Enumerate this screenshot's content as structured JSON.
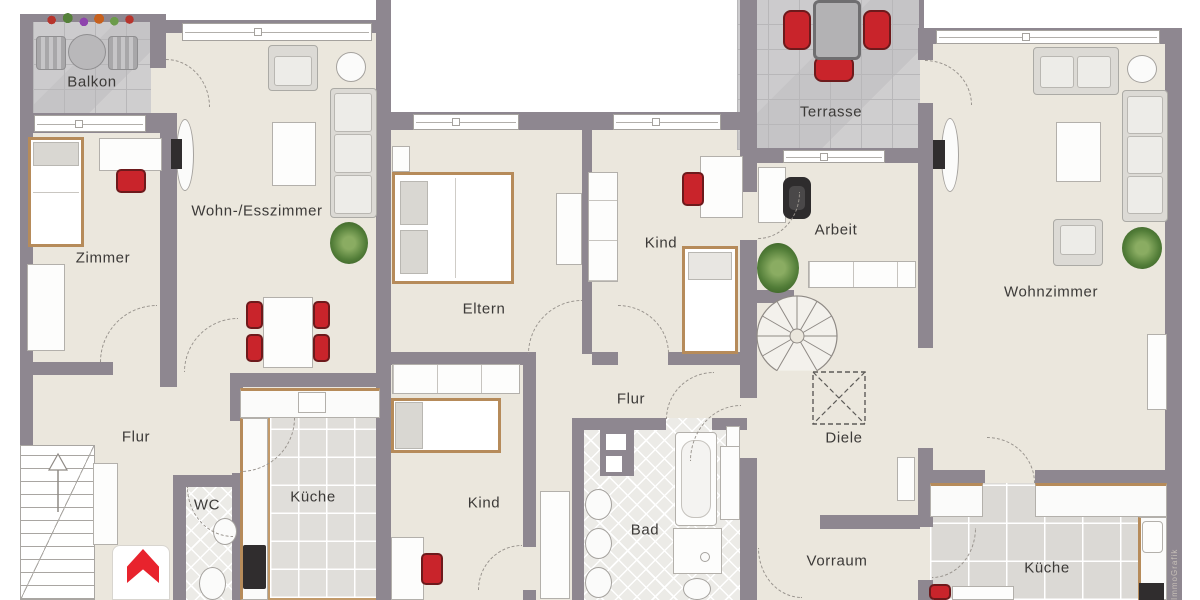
{
  "watermark": "ImmoGrafik",
  "colors": {
    "wall": "#8e8790",
    "floor": "#ebe7dd",
    "accent_red": "#c9242b",
    "wood": "#b68b5a",
    "tile_outdoor": "#c9c8ca"
  },
  "rooms": {
    "balkon": {
      "label": "Balkon"
    },
    "zimmer": {
      "label": "Zimmer"
    },
    "wohn_esszimmer": {
      "label": "Wohn-/Esszimmer"
    },
    "flur_links": {
      "label": "Flur"
    },
    "wc": {
      "label": "WC"
    },
    "kueche_links": {
      "label": "Küche"
    },
    "eltern": {
      "label": "Eltern"
    },
    "kind_oben": {
      "label": "Kind"
    },
    "kind_unten": {
      "label": "Kind"
    },
    "flur_mitte": {
      "label": "Flur"
    },
    "bad": {
      "label": "Bad"
    },
    "terrasse": {
      "label": "Terrasse"
    },
    "arbeit": {
      "label": "Arbeit"
    },
    "wohnzimmer": {
      "label": "Wohnzimmer"
    },
    "diele": {
      "label": "Diele"
    },
    "vorraum": {
      "label": "Vorraum"
    },
    "kueche_rechts": {
      "label": "Küche"
    }
  }
}
